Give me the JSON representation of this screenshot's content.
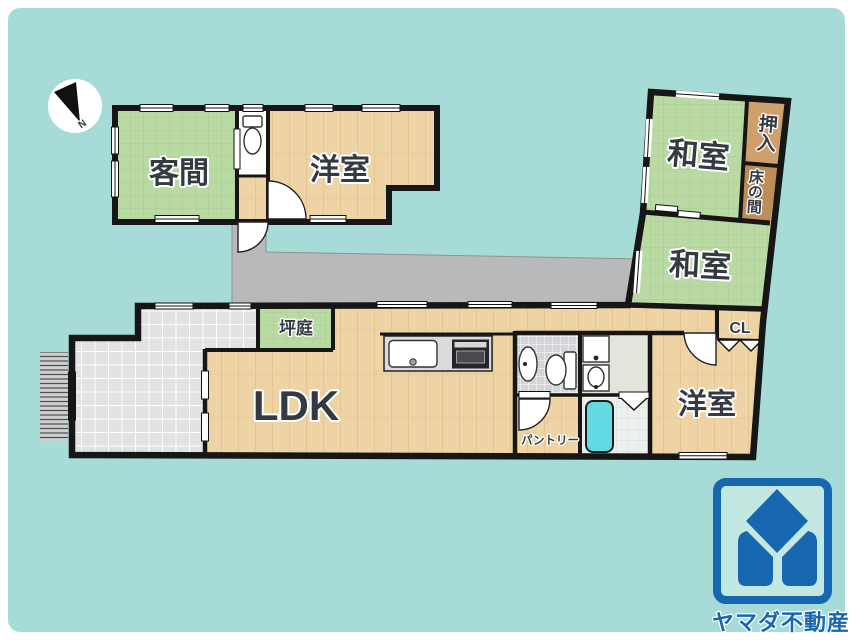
{
  "compass": {
    "north_label": "N"
  },
  "rooms": {
    "kyakuma": "客間",
    "yoshitsu_upper": "洋室",
    "washitsu_upper": "和室",
    "oshiire": "押入",
    "tokonoma": "床の間",
    "washitsu_lower": "和室",
    "closet_cl": "CL",
    "yoshitsu_lower": "洋室",
    "ldk": "LDK",
    "tsuboniwa": "坪庭",
    "pantry": "パントリー"
  },
  "branding": {
    "company": "ヤマダ不動産"
  },
  "colors": {
    "background": "#a7dbd8",
    "wall": "#161616",
    "tatami_green": "#b9daa3",
    "wood_floor": "#eed3a5",
    "closet_tan": "#cfa06c",
    "tokonoma_tan": "#bd8d55",
    "corridor_gray": "#b7b9bb",
    "entrance_tile": "#e3e3e6",
    "bathtub_cyan": "#63d9e2",
    "logo_blue": "#1766b0"
  }
}
